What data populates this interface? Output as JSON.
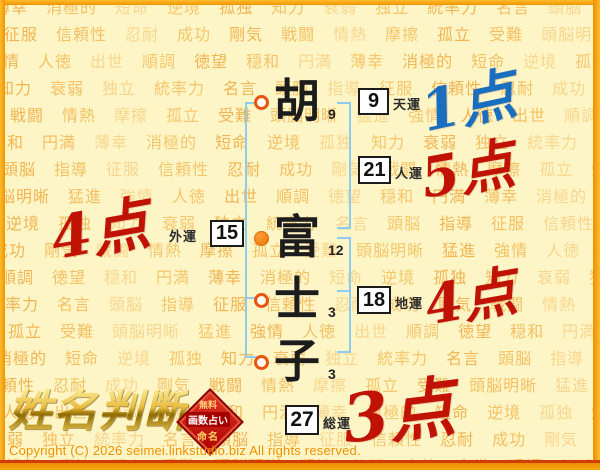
{
  "watermark": {
    "words": [
      "薄幸",
      "消極的",
      "短命",
      "逆境",
      "孤独",
      "知力",
      "衰弱",
      "独立",
      "統率力",
      "名言",
      "頭脳",
      "指導",
      "征服",
      "信頼性",
      "忍耐",
      "成功",
      "剛気",
      "戦闘",
      "情熱",
      "摩擦",
      "孤立",
      "受難",
      "頭脳明晰",
      "猛進",
      "強情",
      "人徳",
      "出世",
      "順調",
      "徳望",
      "穏和",
      "円満"
    ]
  },
  "name": {
    "chars": [
      {
        "char": "胡",
        "strokes": "9",
        "marker": "open"
      },
      {
        "char": "富",
        "strokes": "12",
        "marker": "filled"
      },
      {
        "char": "士",
        "strokes": "3",
        "marker": "open"
      },
      {
        "char": "子",
        "strokes": "3",
        "marker": "open"
      }
    ]
  },
  "fortunes": {
    "tenun": {
      "label": "天運",
      "value": "9",
      "score": "1点"
    },
    "jinun": {
      "label": "人運",
      "value": "21",
      "score": "5点"
    },
    "gaiun": {
      "label": "外運",
      "value": "15",
      "score": "4点"
    },
    "chiun": {
      "label": "地運",
      "value": "18",
      "score": "4点"
    },
    "souun": {
      "label": "総運",
      "value": "27",
      "score": "3点"
    }
  },
  "logo": {
    "title": "姓名判断",
    "badge_line1": "無料",
    "badge_line2": "画数占い",
    "badge_line3": "命名"
  },
  "footer": {
    "copyright": "Copyright (C) 2026 seimei.linkstudio.biz All rights reserved."
  },
  "colors": {
    "background": "#fdf5c6",
    "frame_orange": "#f29400",
    "frame_red_line": "#cf3d02",
    "bracket_blue": "#8ecbf1",
    "score_red": "#c01305",
    "score_blue": "#1a6ec0",
    "watermark_orange": "#f1af42",
    "badge_red": "#c00d0d",
    "logo_gold": "#e9bc3e",
    "copyright_orange": "#ee9100"
  }
}
